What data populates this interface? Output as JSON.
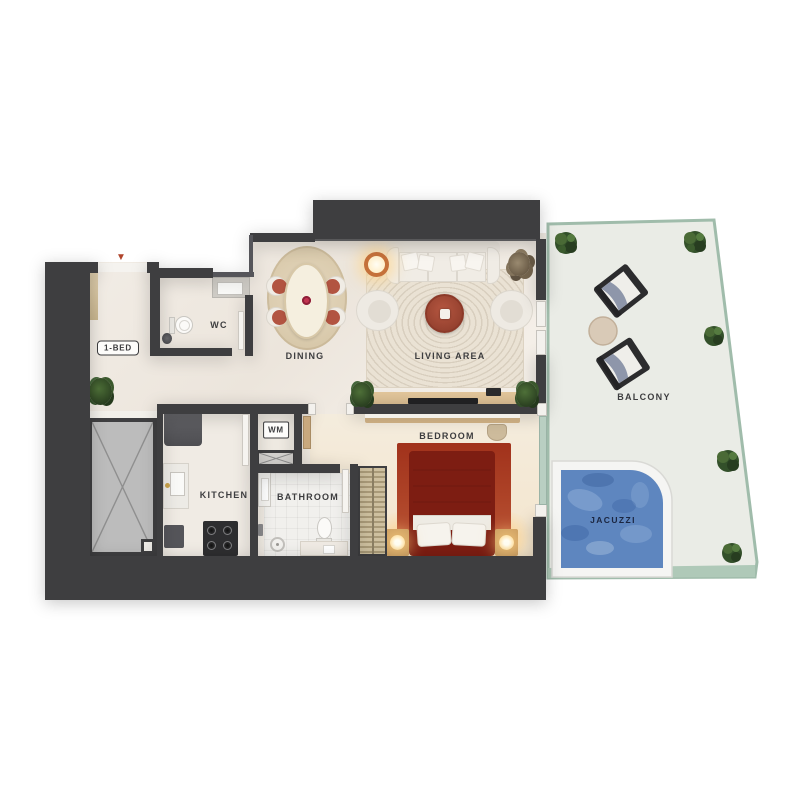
{
  "unit": {
    "badge": "1-BED"
  },
  "rooms": {
    "wc": "WC",
    "dining": "DINING",
    "living": "LIVING AREA",
    "balcony": "BALCONY",
    "bedroom": "BEDROOM",
    "kitchen": "KITCHEN",
    "bathroom": "BATHROOM",
    "wm": "WM",
    "jacuzzi": "JACUZZI"
  },
  "icons": {
    "entry_marker": "▼"
  },
  "palette": {
    "wall": "#3e3e40",
    "floor_cream": "#f1ebe3",
    "bedroom_floor": "#f4e8d4",
    "balcony_floor": "#eaece6",
    "balcony_glass": "#a0bcab",
    "jacuzzi_water": "#5e86bf",
    "entry_marker_red": "#b0452c",
    "dining_chair_terracotta": "#b25441",
    "coffee_table_red": "#a84a34",
    "bed_frame_red": "#7d1d12",
    "bedroom_rug": "#cd7a5c",
    "wood": "#d8bc92",
    "shaft_gray": "#bcbcbc",
    "plant_green": "#3c5c2e",
    "lamp_glow": "#ffd98f"
  }
}
